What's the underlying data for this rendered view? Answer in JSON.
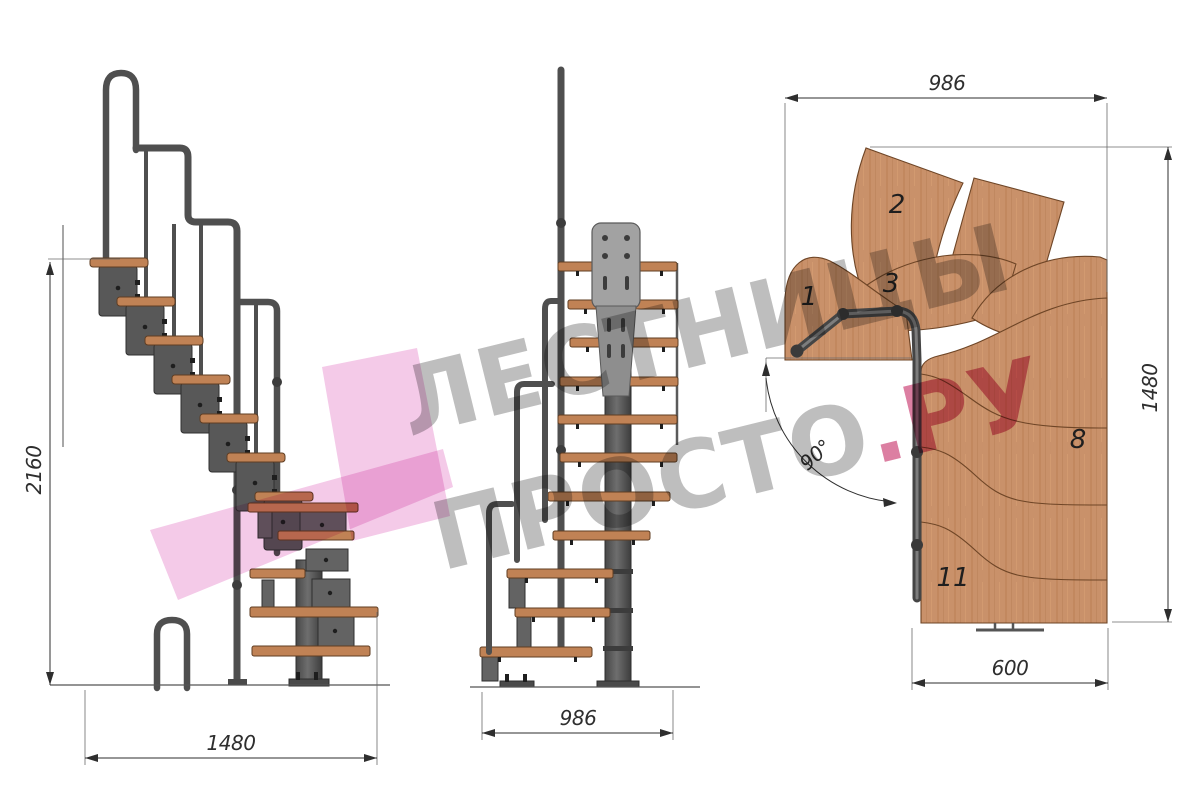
{
  "watermark": {
    "line1": "ЛЕСТНИЦЫ",
    "line2_main": "ПРОСТО",
    "line2_accent": ".РУ"
  },
  "views": {
    "side": {
      "height_label": "2160",
      "run_label": "1480"
    },
    "front": {
      "width_label": "986"
    },
    "plan": {
      "width_label": "986",
      "depth_label": "1480",
      "flight_width_label": "600",
      "angle_label": "90°",
      "tread_labels": [
        "1",
        "2",
        "3",
        "8",
        "11"
      ]
    }
  },
  "colors": {
    "accent_pink": "#d4638d",
    "watermark_gray": "#b0b0b0",
    "arrow_pink": "#f3c4e6",
    "wood": "#c9916a",
    "wood_line": "#6e4526",
    "steel": "#4f4f4f",
    "dim": "#2e2e2e"
  }
}
